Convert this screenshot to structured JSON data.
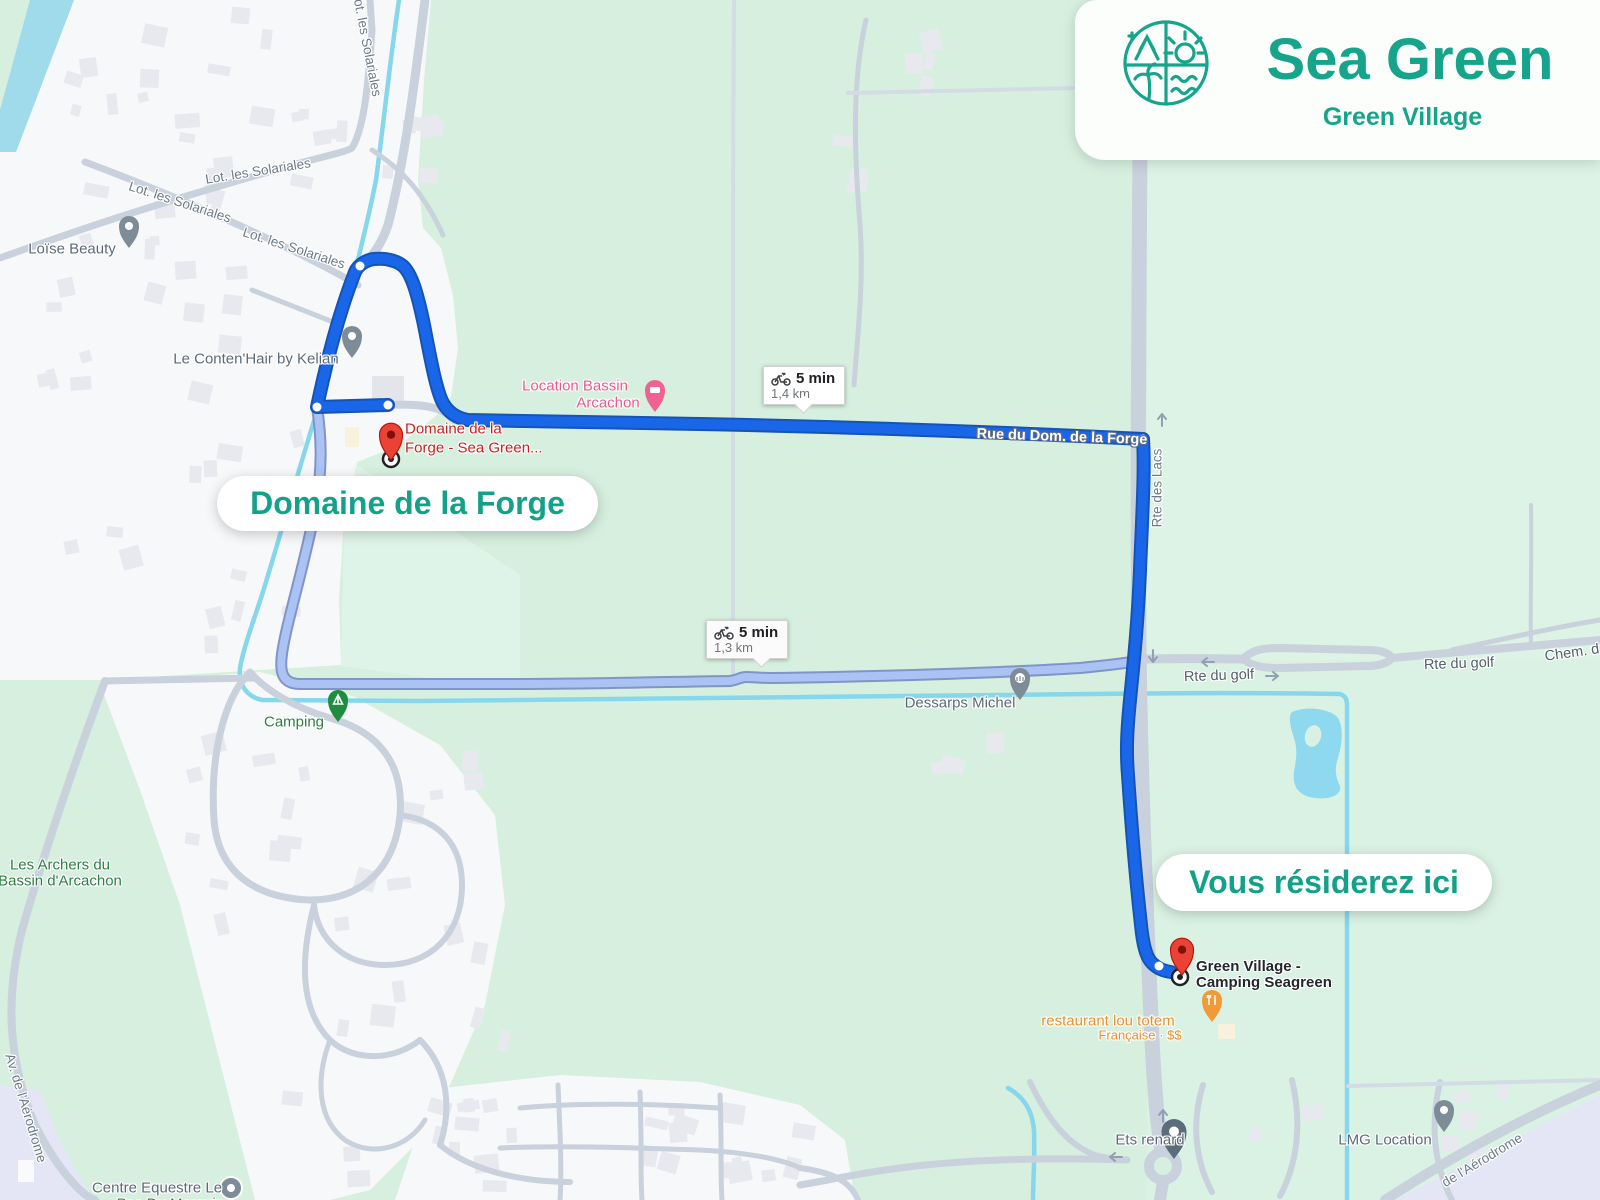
{
  "brand": {
    "name": "Sea Green",
    "subtitle": "Green Village",
    "teal": "#16a58b"
  },
  "callouts": {
    "origin": "Domaine de la Forge",
    "destination": "Vous résiderez ici"
  },
  "badges": [
    {
      "duration": "5 min",
      "distance": "1,4 km",
      "mode": "bicycle"
    },
    {
      "duration": "5 min",
      "distance": "1,3 km",
      "mode": "bicycle"
    }
  ],
  "markers": {
    "origin": {
      "line1": "Domaine de la",
      "line2": "Forge - Sea Green..."
    },
    "destination": {
      "line1": "Green Village -",
      "line2": "Camping Seagreen"
    }
  },
  "streets": {
    "solariales": "Lot. les Solariales",
    "rue_dom_forge": "Rue du Dom. de la Forge",
    "rte_des_lacs": "Rte des Lacs",
    "rte_du_golf": "Rte du golf",
    "chem": "Chem. d",
    "aerodrome": "Av. de l'Aérodrome",
    "aerodrome_partial": "de l'Aérodrome"
  },
  "pois": {
    "loise": "Loïse Beauty",
    "kelian": "Le Conten'Hair by Kelian",
    "location_bassin_1": "Location Bassin",
    "location_bassin_2": "Arcachon",
    "camping": "Camping",
    "archers_1": "Les Archers du",
    "archers_2": "Bassin d'Arcachon",
    "dessarps": "Dessarps Michel",
    "restaurant": "restaurant lou totem",
    "restaurant_sub": "Française · $$",
    "ets": "Ets renard",
    "lmg": "LMG Location",
    "equestre_1": "Centre Equestre Le",
    "equestre_2": "Pas Du Marquis"
  },
  "colors": {
    "route_main": "#1a66e8",
    "route_alt": "#abc3f4",
    "water": "#86d7ec",
    "marker_red": "#ea4335"
  }
}
